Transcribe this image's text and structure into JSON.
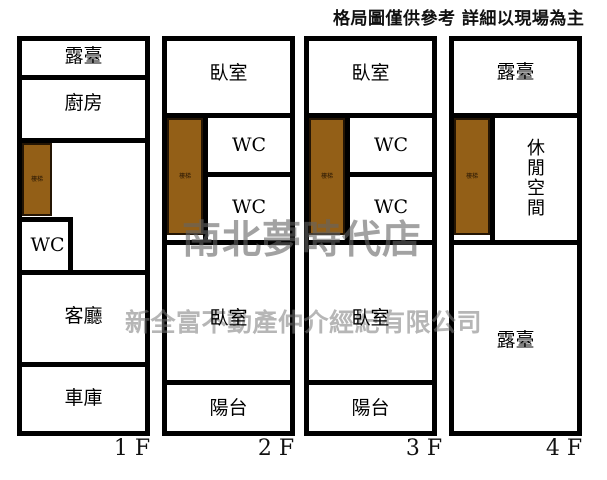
{
  "disclaimer": "格局圖僅供參考 詳細以現場為主",
  "watermarks": {
    "store_name": "南北夢時代店",
    "company_name": "新全富不動產仲介經紀有限公司"
  },
  "colors": {
    "wall": "#000000",
    "stairs_fill": "#935f17",
    "stairs_border": "#241504",
    "watermark_gray": "#7a7a7a"
  },
  "floors": [
    {
      "label": "1 F",
      "rooms": {
        "terrace": "露臺",
        "kitchen": "廚房",
        "stairs": "樓梯",
        "wc": "WC",
        "living": "客廳",
        "garage": "車庫"
      }
    },
    {
      "label": "2 F",
      "rooms": {
        "bedroom_top": "臥室",
        "stairs": "樓梯",
        "wc_top": "WC",
        "wc_bottom": "WC",
        "bedroom_bottom": "臥室",
        "balcony": "陽台"
      }
    },
    {
      "label": "3 F",
      "rooms": {
        "bedroom_top": "臥室",
        "stairs": "樓梯",
        "wc_top": "WC",
        "wc_bottom": "WC",
        "bedroom_bottom": "臥室",
        "balcony": "陽台"
      }
    },
    {
      "label": "4 F",
      "rooms": {
        "terrace_top": "露臺",
        "stairs": "樓梯",
        "leisure": "休閒空間",
        "terrace_main": "露臺"
      }
    }
  ]
}
